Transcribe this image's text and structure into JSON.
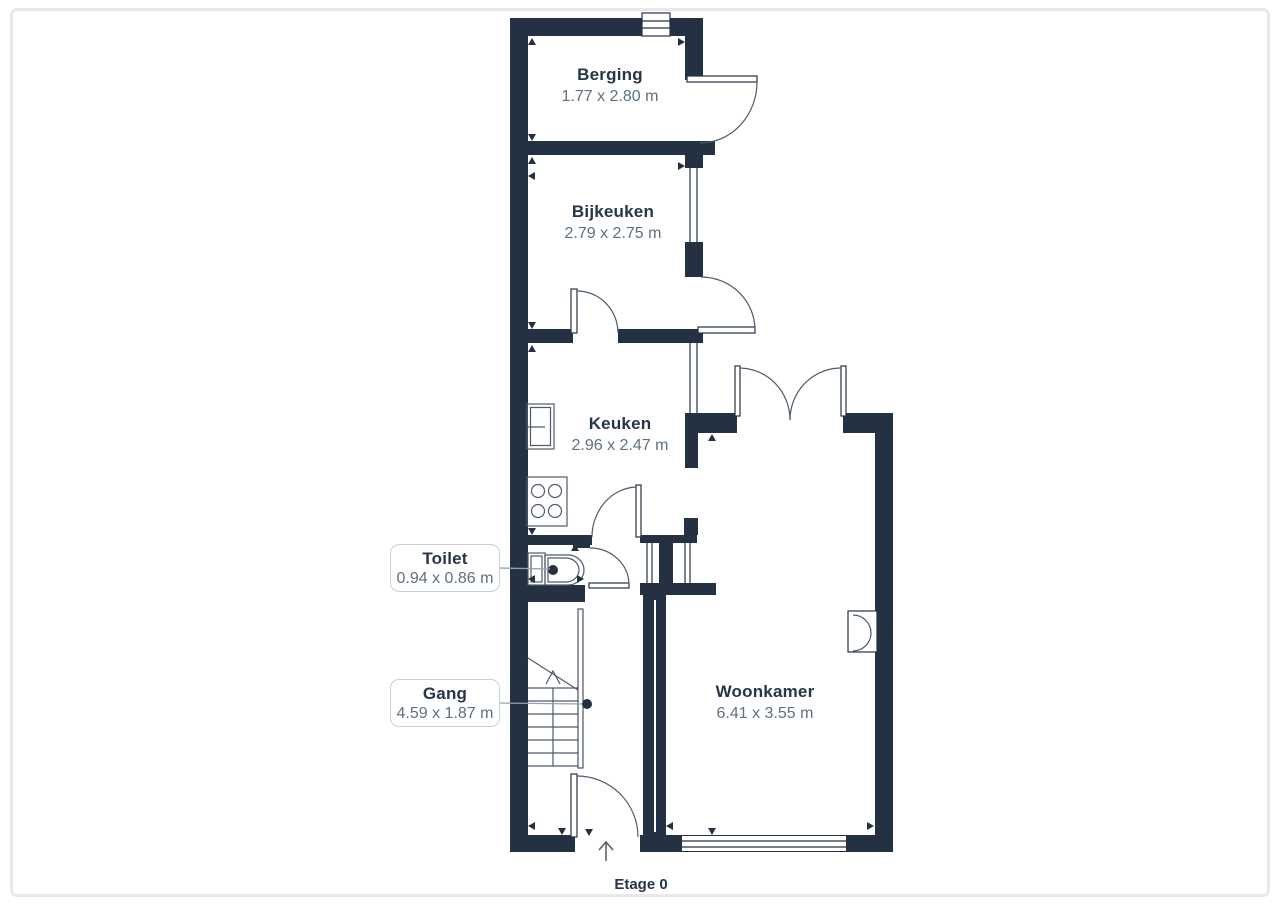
{
  "page": {
    "floor_label": "Etage 0"
  },
  "rooms": {
    "berging": {
      "name": "Berging",
      "dims": "1.77 x 2.80 m"
    },
    "bijkeuken": {
      "name": "Bijkeuken",
      "dims": "2.79 x 2.75 m"
    },
    "keuken": {
      "name": "Keuken",
      "dims": "2.96 x 2.47 m"
    },
    "toilet": {
      "name": "Toilet",
      "dims": "0.94 x 0.86 m"
    },
    "gang": {
      "name": "Gang",
      "dims": "4.59 x 1.87 m"
    },
    "woonkamer": {
      "name": "Woonkamer",
      "dims": "6.41 x 3.55 m"
    }
  },
  "fixtures": [
    "toilet",
    "sink",
    "stove",
    "stairs",
    "radiator",
    "entrance-arrow"
  ],
  "symbols": {
    "entrance_arrow": "↑"
  },
  "colors": {
    "wall": "#243142",
    "room_title": "#263649",
    "room_dims": "#5e7080",
    "label_box_border": "#c9d0d9",
    "leader_line": "#98a1ad",
    "page_border": "#e9e9ec"
  }
}
